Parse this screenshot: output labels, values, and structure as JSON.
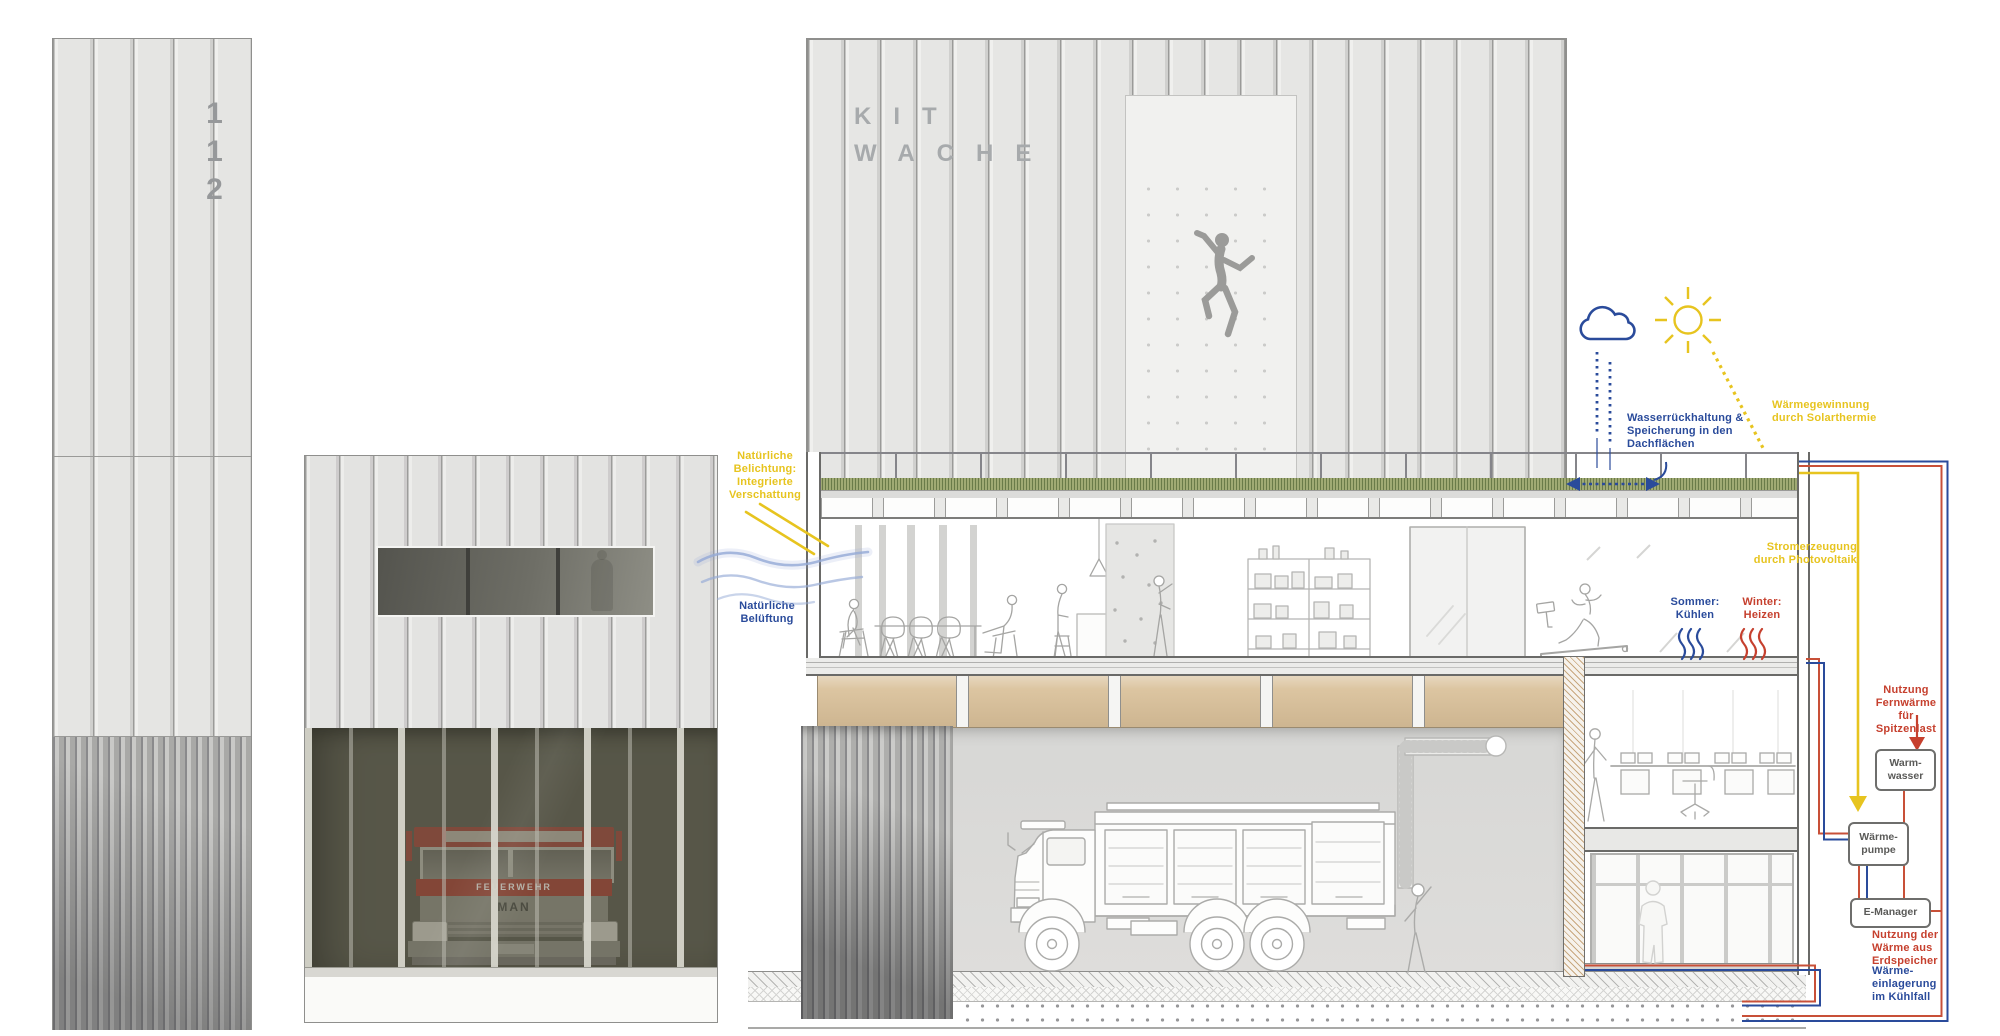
{
  "palette": {
    "annotation_blue": "#2a4b9b",
    "annotation_yellow": "#e7c41f",
    "annotation_red": "#c6402e",
    "circuit_red": "#c85038",
    "facade_gray": "#e8e8e6",
    "garage_glass": "#605f51",
    "green_roof": "#a0aa74",
    "timber_beam": "#dcc5a1",
    "truck_red": "#a34636"
  },
  "buildings": {
    "tower": {
      "number": "112"
    },
    "hall": {
      "name": "KIT\nWACHE"
    },
    "garage_truck": {
      "band": "FEUERWEHR",
      "logo": "MAN"
    }
  },
  "annotations": {
    "daylight": "Natürliche\nBelichtung:\nIntegrierte\nVerschattung",
    "ventilation": "Natürliche\nBelüftung",
    "water_retention": "Wasserrückhaltung &\nSpeicherung in den\nDachflächen",
    "solar_thermal": "Wärmegewinnung\ndurch Solarthermie",
    "photovoltaics": "Stromerzeugung\ndurch Photovoltaik",
    "summer": "Sommer:\nKühlen",
    "winter": "Winter:\nHeizen",
    "district_heating": "Nutzung\nFernwärme\nfür Spitzenlast",
    "geothermal_use": "Nutzung der\nWärme aus\nErdspeicher",
    "cooling_storage": "Wärme-\neinlagerung\nim Kühlfall"
  },
  "nodes": {
    "hot_water": "Warm-\nwasser",
    "heat_pump": "Wärme-\npumpe",
    "e_manager": "E-Manager"
  }
}
